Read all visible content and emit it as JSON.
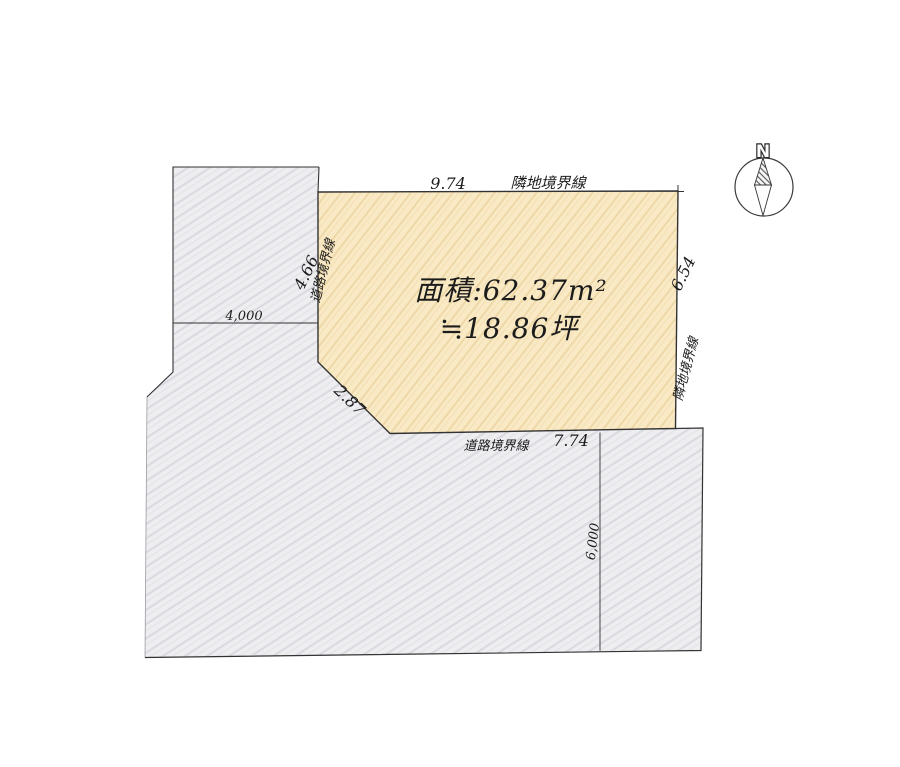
{
  "colors": {
    "lot_fill": "#f9e9c4",
    "road_fill": "#eeeef1",
    "outline": "#333333"
  },
  "lot": {
    "area_m2": "面積:62.37m²",
    "area_tsubo": "≒18.86坪"
  },
  "dimensions": {
    "top": "9.74",
    "right": "6.54",
    "bottom": "7.74",
    "left": "4.66",
    "diagonal": "2.87",
    "left_road_width": "4,000",
    "bottom_road_width": "6,000"
  },
  "boundaries": {
    "top": "隣地境界線",
    "right": "隣地境界線",
    "left": "道路境界線",
    "bottom": "道路境界線"
  },
  "compass": {
    "north": "N"
  }
}
